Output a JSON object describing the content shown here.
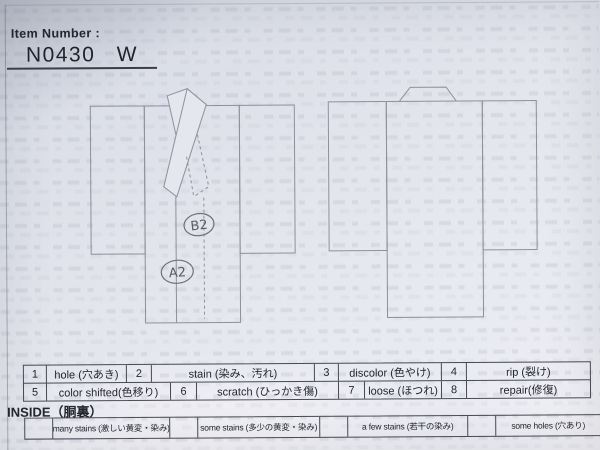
{
  "header": {
    "label": "Item Number :",
    "value": "N0430 W"
  },
  "annotations": {
    "b": "B2",
    "a": "A2"
  },
  "defect_table": {
    "cells": [
      {
        "num": "1",
        "label": "hole (穴あき)"
      },
      {
        "num": "2",
        "label": "stain (染み、汚れ)"
      },
      {
        "num": "3",
        "label": "discolor (色やけ)"
      },
      {
        "num": "4",
        "label": "rip (裂け)"
      },
      {
        "num": "5",
        "label": "color shifted(色移り)"
      },
      {
        "num": "6",
        "label": "scratch (ひっかき傷)"
      },
      {
        "num": "7",
        "label": "loose (ほつれ)"
      },
      {
        "num": "8",
        "label": "repair(修復)"
      }
    ]
  },
  "inside": {
    "title": "INSIDE（胴裏）",
    "options": [
      {
        "label": "many stains (激しい黄変・染み)"
      },
      {
        "label": "some stains (多少の黄変・染み)"
      },
      {
        "label": "a few stains (若干の染み)"
      },
      {
        "label": "some holes (穴あり)"
      }
    ]
  }
}
